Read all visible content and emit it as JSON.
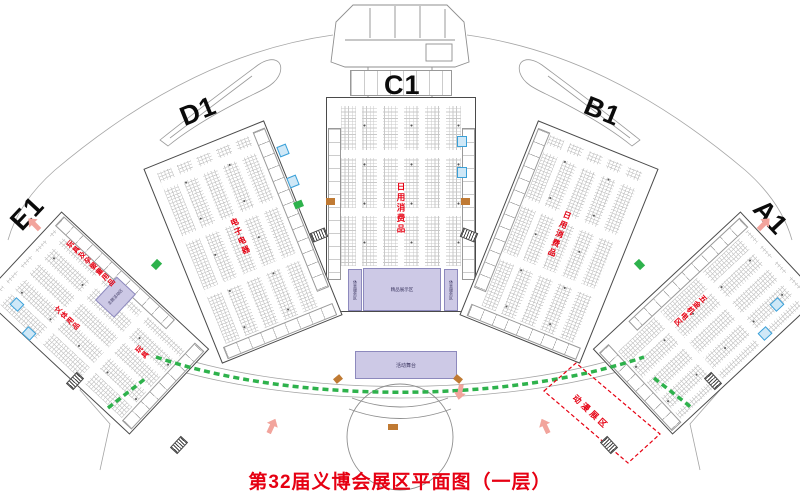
{
  "title": "第32届义博会展区平面图（一层）",
  "halls": {
    "c1": {
      "label": "C1",
      "category": "日用消费品"
    },
    "d1": {
      "label": "D1",
      "category": "电子电器"
    },
    "b1": {
      "label": "B1",
      "category": "日用消费品"
    },
    "a1": {
      "label": "A1",
      "category": "五金机电区"
    },
    "e1": {
      "label": "E1",
      "category_main": "玩具及孕婴童用品",
      "category_2": "文体用品",
      "category_3": "玩具"
    }
  },
  "zones": {
    "c1_center_block": "精品展示区",
    "c1_left_block": "休息服务区",
    "c1_right_block": "休息服务区",
    "e1_block": "主题活动区",
    "stage": "活动舞台",
    "dashed_zone": "动漫展区"
  },
  "colors": {
    "red": "#e60012",
    "green": "#2eb24c",
    "orange": "#c07a33",
    "purple": "#cdc9e6",
    "blue": "#3aa0d8",
    "pink": "#f2a49c"
  }
}
